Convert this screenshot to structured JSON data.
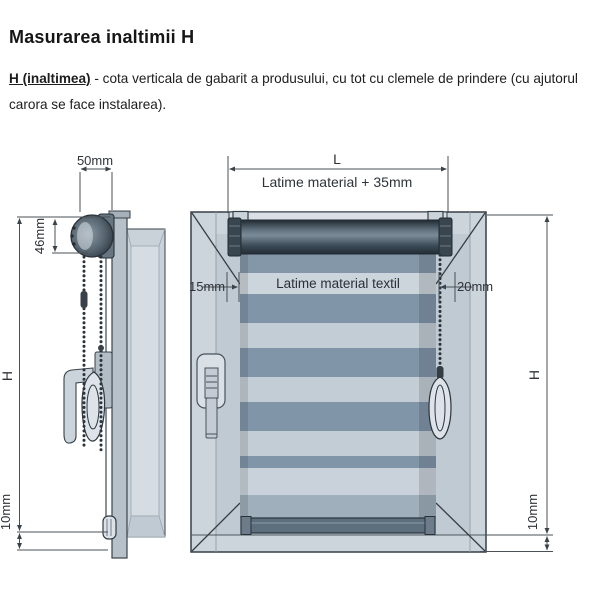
{
  "header": {
    "title": "Masurarea inaltimii H",
    "definition_term": "H (inaltimea)",
    "definition_rest": " - cota verticala de gabarit a produsului, cu tot cu clemele de prindere (cu ajutorul carora se face instalarea)."
  },
  "diagram": {
    "side_view": {
      "dim_depth": "50mm",
      "dim_cassette_height": "46mm",
      "dim_height": "H",
      "dim_bottom_gap": "10mm"
    },
    "front_view": {
      "dim_total_width": "L",
      "dim_total_width_note": "Latime material + 35mm",
      "dim_left_offset": "15mm",
      "fabric_width_label": "Latime material textil",
      "dim_right_offset": "20mm",
      "dim_height": "H",
      "dim_bottom_gap": "10mm"
    }
  },
  "colors": {
    "outline": "#3a424a",
    "dimension_line": "#4a5057",
    "frame_face": "#ccd5dc",
    "frame_reveal": "#c0cad2",
    "stripe_dark": "#8095a8",
    "stripe_light": "#c3cdd5",
    "tube_dark": "#222c34",
    "plastic_light": "#dde3e9"
  }
}
